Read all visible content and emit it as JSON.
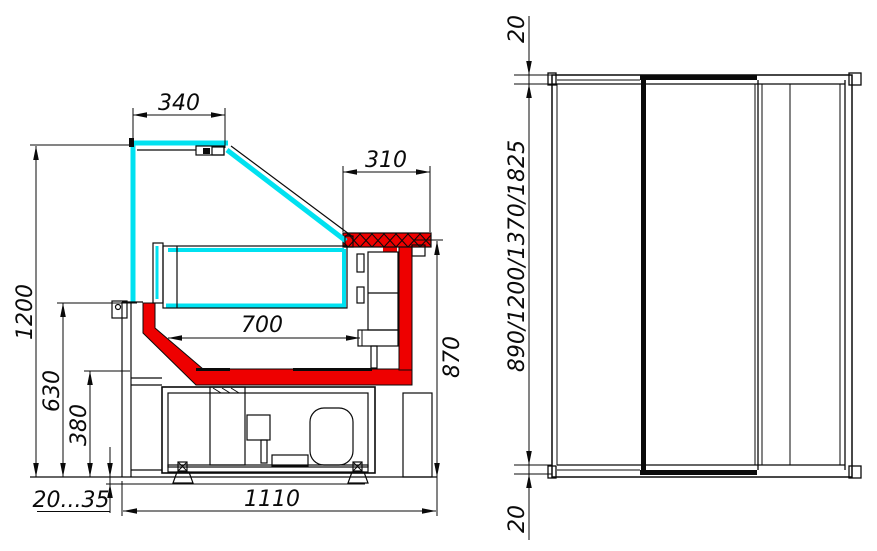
{
  "drawing": {
    "title": "Refrigerated display counter dimensional drawing",
    "units": "mm",
    "colors": {
      "glass_cyan": "#00E1F0",
      "accent_red": "#EE0000",
      "line_black": "#0a0a0a"
    },
    "section_view": {
      "name": "cross-section view",
      "dims": {
        "canopy_width": "340",
        "rear_shelf_depth": "310",
        "overall_height": "1200",
        "display_well_width": "700",
        "rear_counter_height": "870",
        "front_panel_height": "630",
        "base_height": "380",
        "leg_adjust_range": "20...35",
        "overall_depth": "1110"
      }
    },
    "side_view": {
      "name": "end view",
      "dims": {
        "top_overhang": "20",
        "length_options": "890/1200/1370/1825",
        "bottom_overhang": "20"
      }
    }
  }
}
